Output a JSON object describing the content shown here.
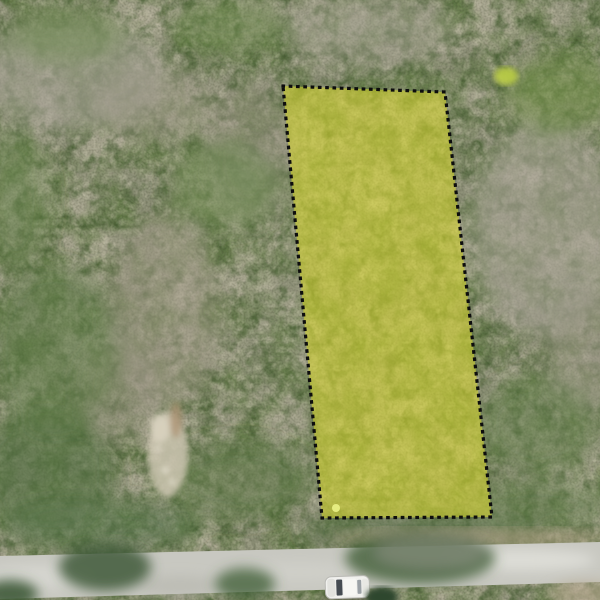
{
  "scene": {
    "type": "aerial-drone-photo",
    "description": "Top-down drone photo of dry scrubland. A land parcel is outlined with a black dotted boundary and filled with a translucent yellow highlight. A light gray dirt road runs along the bottom edge with a white car parked on it and tree canopies overhanging.",
    "palette": {
      "vegetation_base": "#8d9077",
      "green_patch": "#5f7c48",
      "dry_patch": "#a8a497",
      "branch_veins": "#dbd7c5",
      "canopy_shadow": "#3f5a38",
      "rock_clearing": "#ccc5b2"
    }
  },
  "parcel": {
    "points": "283,86 445,92 492,517 322,518",
    "fill": "#d8d831",
    "fill_opacity": "0.58",
    "border_color": "#0d0d0d",
    "border_width": "3.2",
    "border_dasharray": "0.5 6.8",
    "corner_dot": {
      "cx": "336",
      "cy": "508",
      "r": "4",
      "fill": "#e9ef84"
    }
  },
  "road": {
    "points": "0,556 600,542 600,582 0,599",
    "fill": "#c8c8c1"
  },
  "vehicle": {
    "transform": "translate(325,577) rotate(-2)",
    "body_fill": "#f0f0ed",
    "glass_fill": "#454b52",
    "body_width": "44",
    "body_height": "22"
  },
  "flowering_bush": {
    "cx": "506",
    "cy": "76",
    "rx": "12",
    "ry": "9",
    "fill": "#bccf45"
  }
}
